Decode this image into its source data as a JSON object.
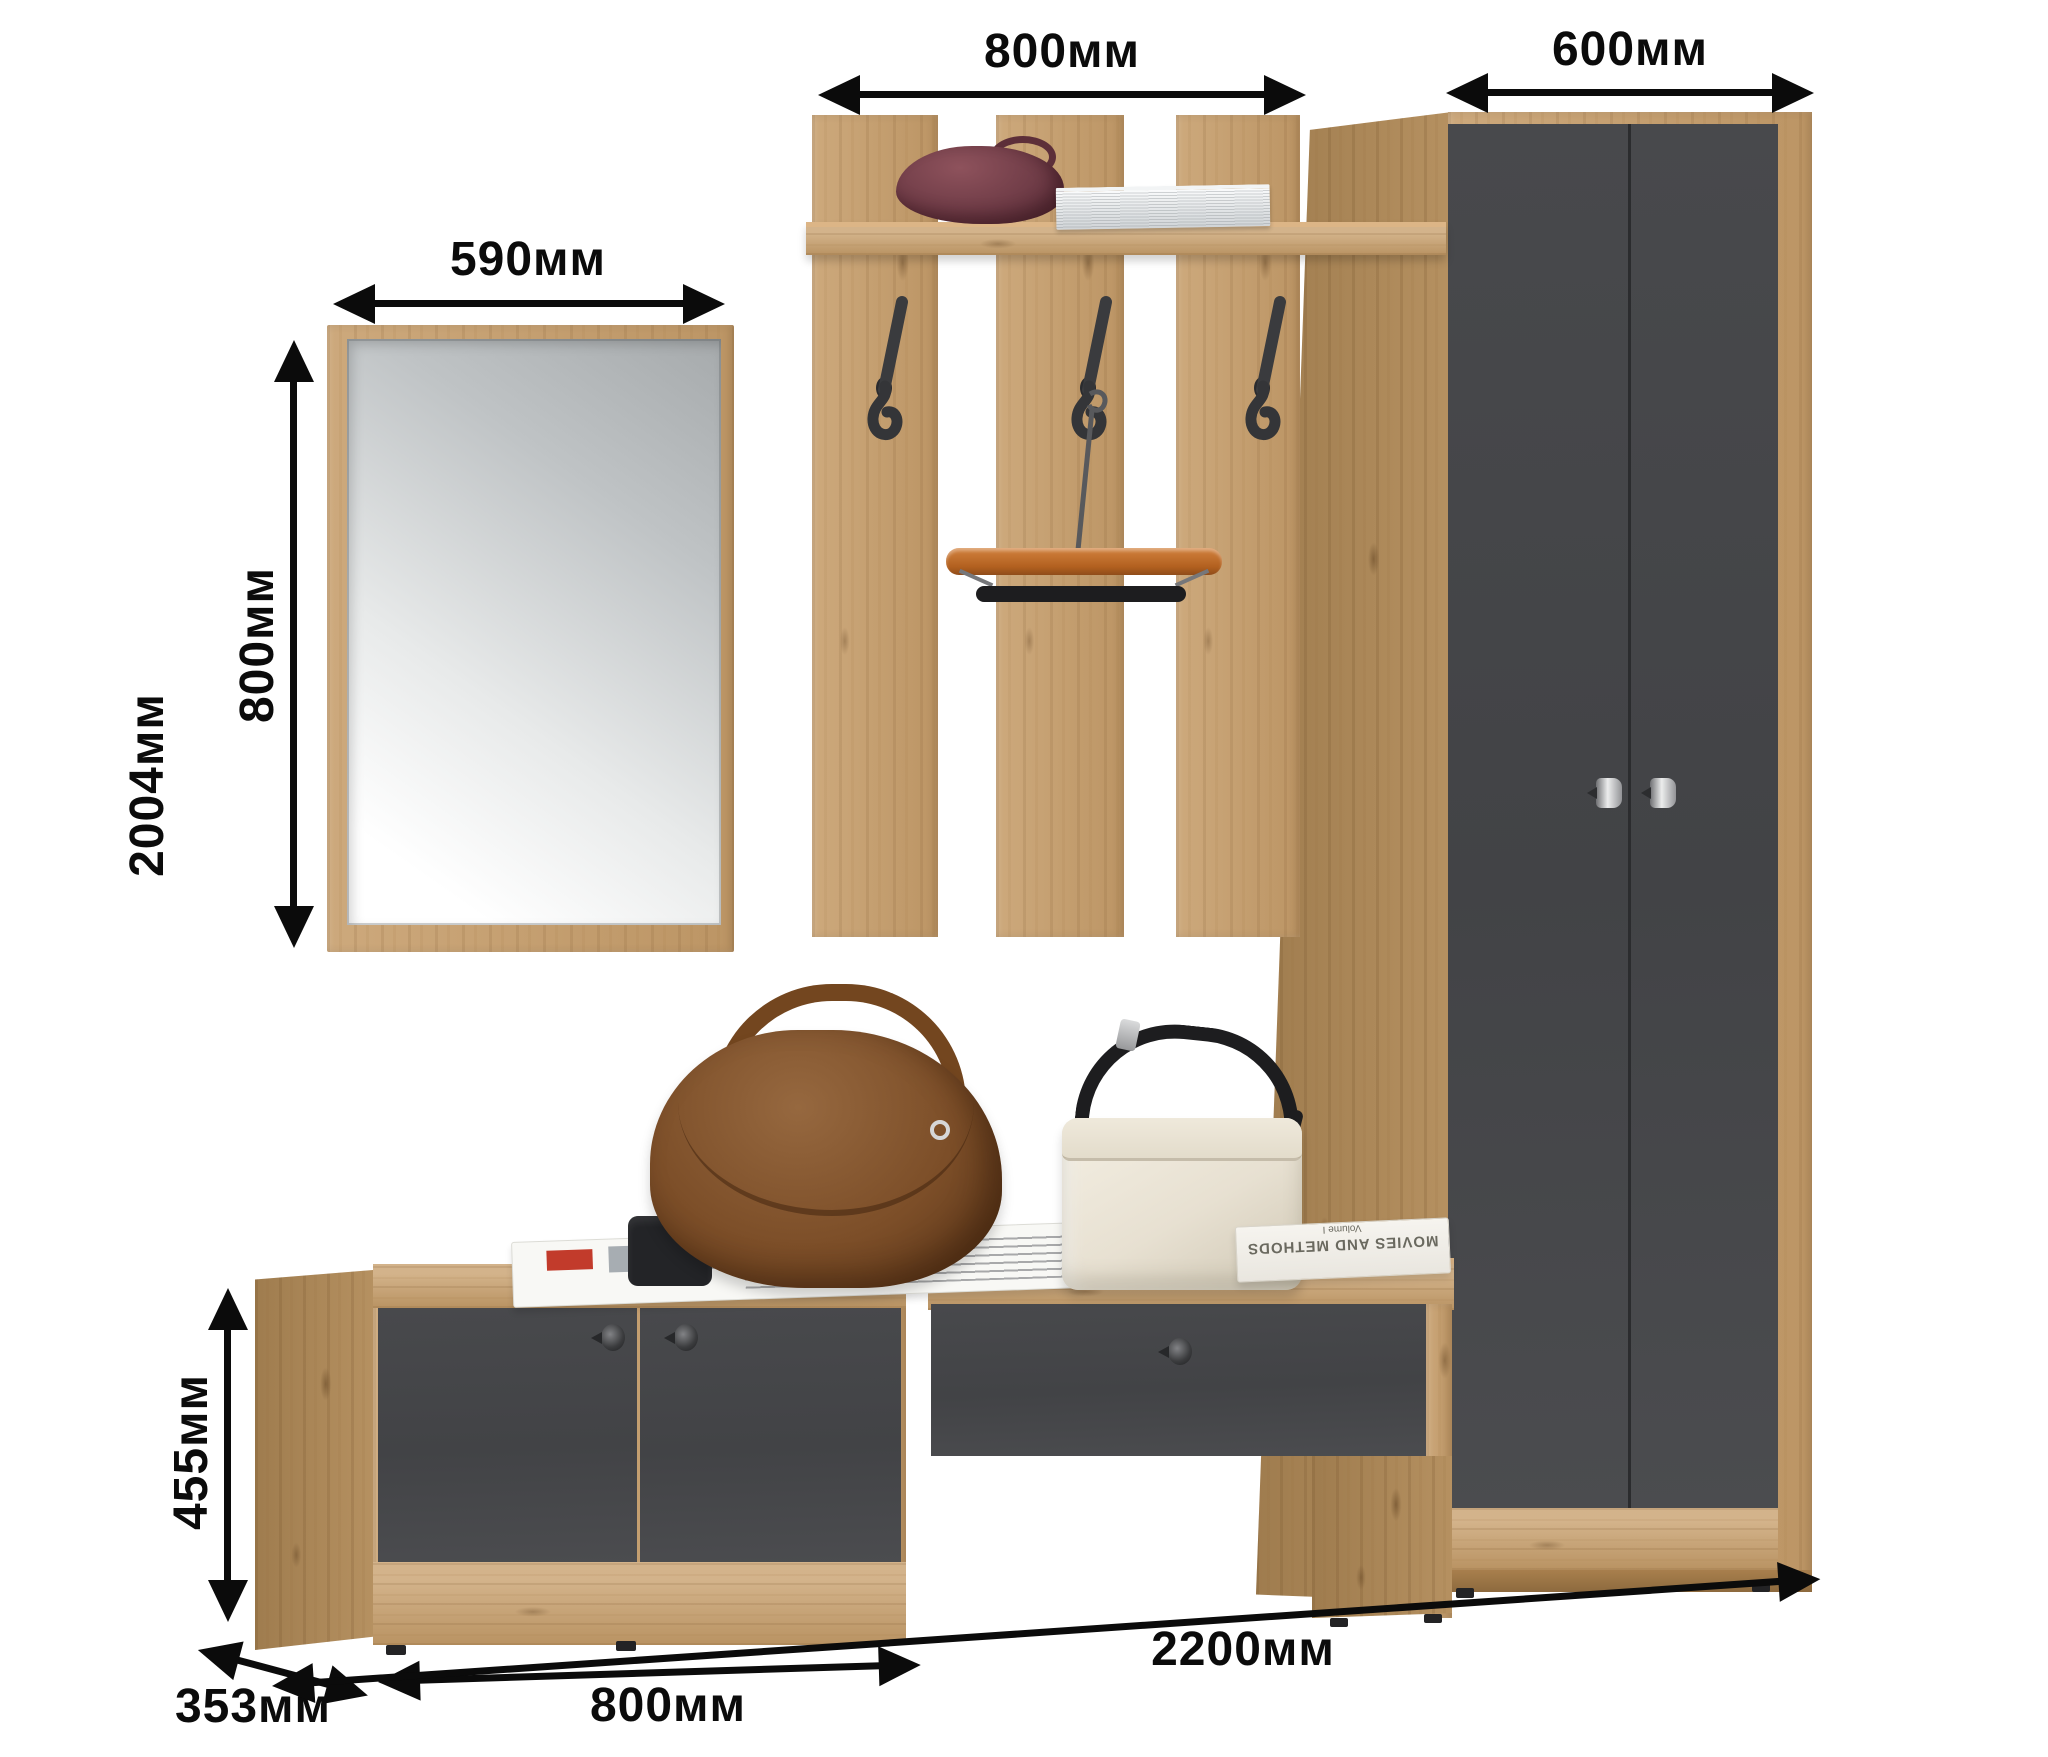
{
  "annotations": {
    "mirror_width": "590мм",
    "panel_width": "800мм",
    "wardrobe_width": "600мм",
    "mirror_height": "800мм",
    "total_height": "2004мм",
    "cabinet_height": "455мм",
    "cabinet_depth": "353мм",
    "cabinet_width": "800мм",
    "total_width": "2200мм"
  },
  "props": {
    "book_title": "MOVIES AND METHODS",
    "book_subtitle": "Volume I"
  },
  "palette": {
    "oak": "#c69d6a",
    "oak_dark": "#b18a57",
    "graphite": "#46474a",
    "annotation": "#0b0b0b",
    "background": "#ffffff"
  }
}
